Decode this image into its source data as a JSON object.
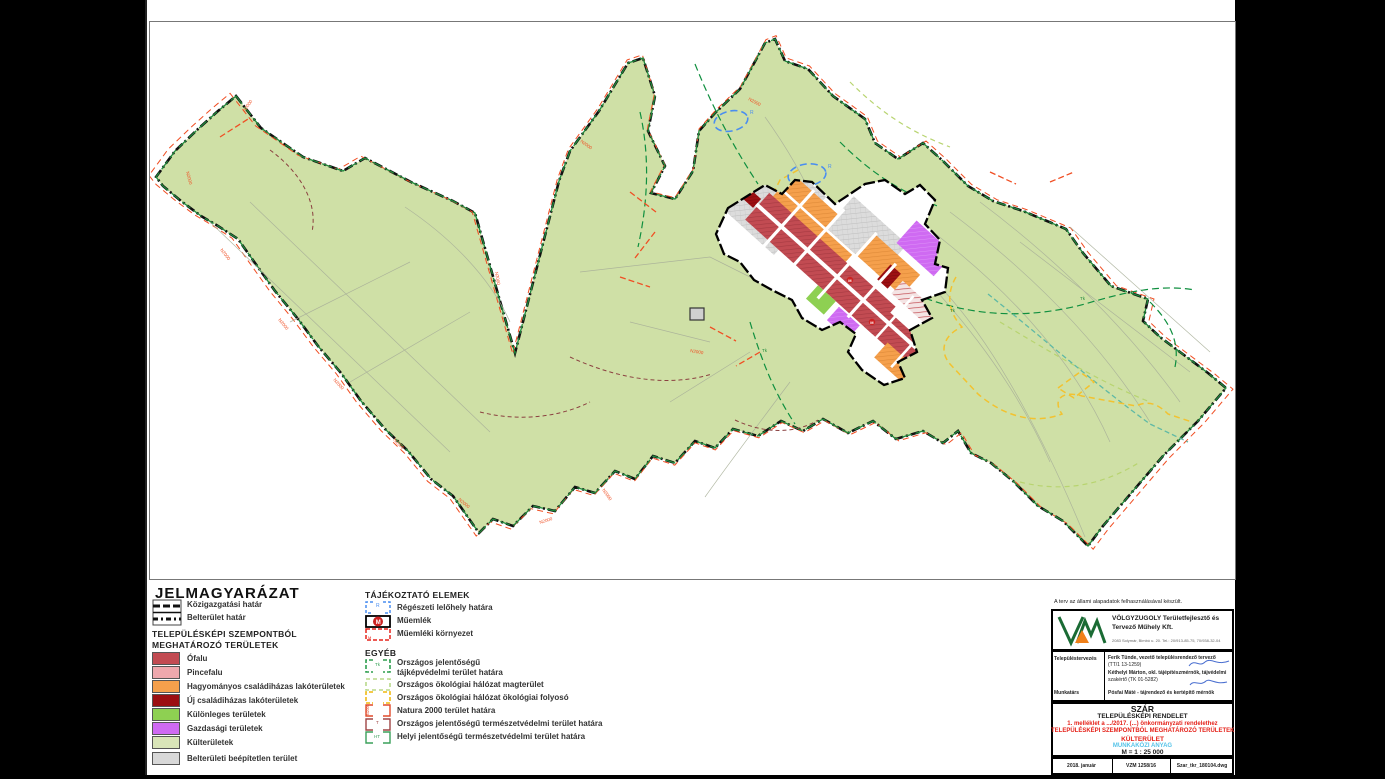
{
  "legend": {
    "title": "JELMAGYARÁZAT",
    "boundary_items": [
      {
        "label": "Közigazgatási határ"
      },
      {
        "label": "Belterület határ"
      }
    ],
    "section_title_line1": "TELEPÜLÉSKÉPI SZEMPONTBÓL",
    "section_title_line2": "MEGHATÁROZÓ TERÜLETEK",
    "area_items": [
      {
        "label": "Ófalu",
        "color": "#c24b52"
      },
      {
        "label": "Pincefalu",
        "color": "#efa8ad"
      },
      {
        "label": "Hagyományos családiházas lakóterületek",
        "color": "#f5a04c"
      },
      {
        "label": "Új családiházas lakóterületek",
        "color": "#9c0f12"
      },
      {
        "label": "Különleges területek",
        "color": "#8ed052"
      },
      {
        "label": "Gazdasági területek",
        "color": "#cf6af2"
      },
      {
        "label": "Külterületek",
        "color": "#d9e5b8"
      },
      {
        "label": "Belterületi beépítetlen terület",
        "color": "#d8d8d8"
      }
    ],
    "info_title": "TÁJÉKOZTATÓ ELEMEK",
    "info_items": [
      {
        "label": "Régészeti lelőhely határa",
        "symbol": "R",
        "color": "#4a8ef0"
      },
      {
        "label": "Műemlék",
        "symbol": "M",
        "color": "#cc2222"
      },
      {
        "label": "Műemléki környezet",
        "symbol": "M",
        "color": "#e5231b"
      }
    ],
    "other_title": "EGYÉB",
    "other_items": [
      {
        "label_line1": "Országos jelentőségű",
        "label_line2": "tájképvédelmi terület határa",
        "symbol": "Tk",
        "color": "#2e9e4f"
      },
      {
        "label": "Országos ökológiai hálózat magterület",
        "color": "#b8d98a"
      },
      {
        "label": "Országos ökológiai hálózat ökológiai folyosó",
        "color": "#f2c230"
      },
      {
        "label": "Natura 2000 terület határa",
        "symbol": "N2000",
        "color": "#e04a2a"
      },
      {
        "label": "Országos jelentőségű természetvédelmi terület határa",
        "symbol": "T",
        "color": "#a04545"
      },
      {
        "label": "Helyi jelentőségű természetvédelmi terület határa",
        "symbol": "HT",
        "color": "#3aa05a"
      }
    ]
  },
  "titleblock": {
    "disclaimer": "A terv az állami alapadatok felhasználásával készült.",
    "company_name_line1": "VÖLGYZUGOLY Területfejlesztő és",
    "company_name_line2": "Tervező Műhely Kft.",
    "company_address": "2083 Solymár, Bimbó u. 20. Tel.: 20/913-85-75, 70/938-32-04",
    "row1_label": "Településtervezés",
    "row1_line1": "Ferik Tünde, vezető településrendező tervező",
    "row1_line2": "(TT/1 13-1259)",
    "row1_line3": "Kéthelyi Márton, okl. tájépítészmérnök, tájvédelmi",
    "row1_line4": "szakértő (TK 01-5282)",
    "row2_label": "Munkatárs",
    "row2_line1": "Pósfai Máté - tájrendező és kertépítő mérnök",
    "settlement": "SZÁR",
    "doc_type": "TELEPÜLÉSKÉPI RENDELET",
    "annex_line": "1. melléklet a .../2017. (...) önkormányzati rendelethez",
    "subject_line1": "TELEPÜLÉSKÉPI SZEMPONTBÓL MEGHATÁROZÓ TERÜLETEK",
    "subject_line2": "KÜLTERÜLET",
    "status": "MUNKAKÖZI ANYAG",
    "scale": "M = 1 : 25 000",
    "date": "2018. január",
    "project_no": "VZM 1258/16",
    "file_name": "Szar_tkr_180104.dwg"
  },
  "map": {
    "n2000_label": "N2000",
    "arch_label": "R",
    "monument_label": "M",
    "landscape_label": "Tk",
    "colors": {
      "kulterulet": "#cfe0a6",
      "boundary_black": "#111111",
      "boundary_green": "#1f8a3c",
      "natura_red": "#f04e23",
      "eco_yellow": "#f2c230",
      "eco_teal": "#5fb9a5",
      "eco_pale_green": "#b8d470",
      "arch_blue": "#4a8ef0",
      "forest_green": "#0f8f3f",
      "ofalu": "#c24b52",
      "pincefalu": "#efa8ad",
      "hagyomanyos": "#f5a04c",
      "uj_csaladihazas": "#9c0f12",
      "kulonleges": "#8ed052",
      "gazdasagi": "#cf6af2",
      "beepitetlen": "#d6d6d6"
    }
  }
}
